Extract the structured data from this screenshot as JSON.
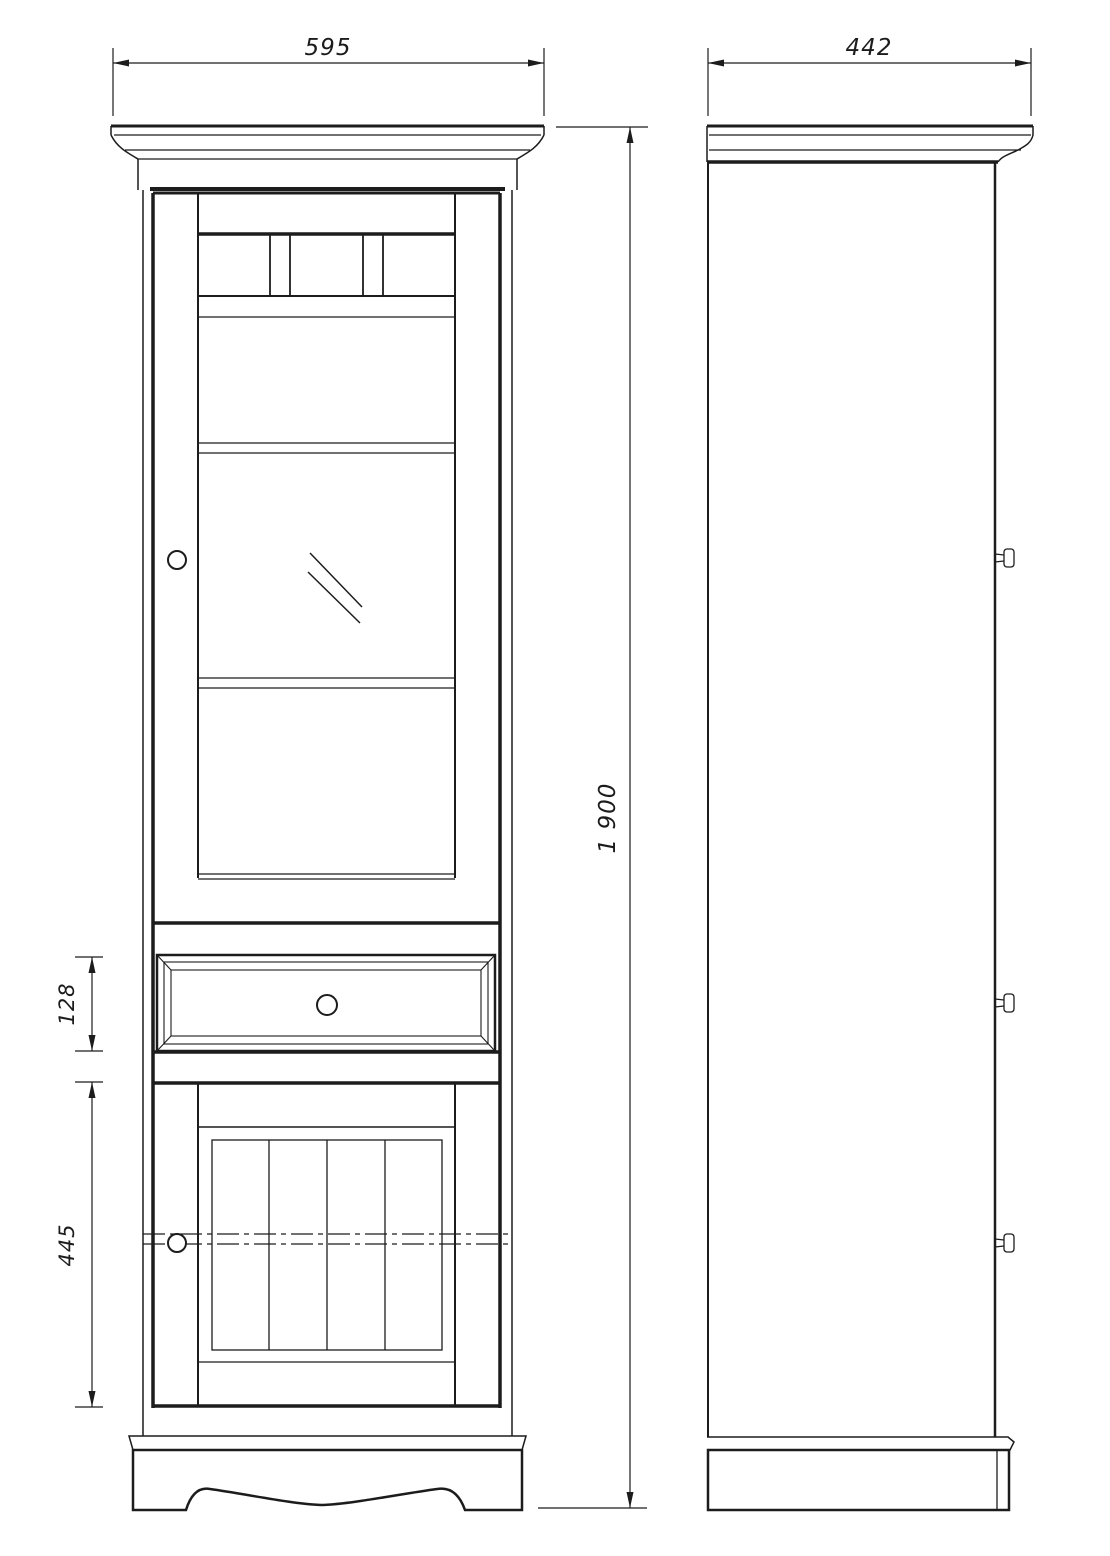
{
  "drawing": {
    "type": "furniture-technical-drawing",
    "dimensions": {
      "width": "595",
      "depth": "442",
      "height": "1 900",
      "drawer_height": "128",
      "lower_door_height": "445"
    },
    "colors": {
      "line": "#1c1c1c",
      "background": "#ffffff"
    }
  }
}
